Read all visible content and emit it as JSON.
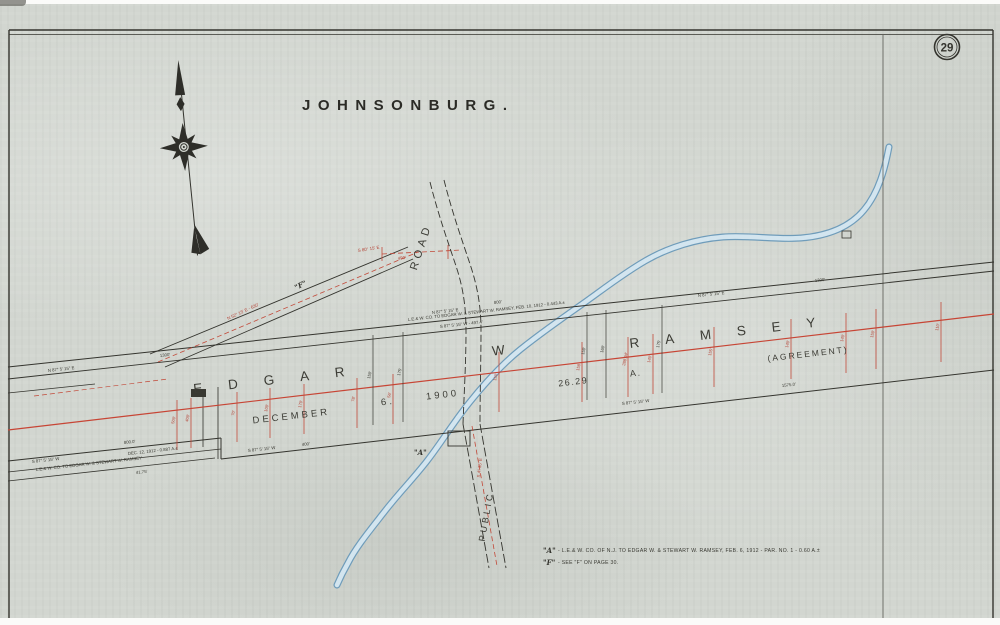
{
  "sheet": {
    "title": "JOHNSONBURG.",
    "number": "29"
  },
  "owner": {
    "first": "EDGAR",
    "middle": "W",
    "last": "RAMSEY"
  },
  "parcel": {
    "agreement": "(AGREEMENT)",
    "area_value": "26.29",
    "area_unit": "A.",
    "date_month": "DECEMBER",
    "date_day": "6.",
    "date_year": "1900"
  },
  "roads": {
    "road": "ROAD",
    "public": "PUBLIC",
    "public_bearing": "S 4° 35' E"
  },
  "spur": {
    "ref": "\"F\"",
    "bearing": "N 52° 15' E - 630'",
    "stub_bearing": "S 80° 15' E",
    "stub_length": "490'"
  },
  "boundaries": {
    "nw_bearing": "N 87° 5' 15\" E",
    "nw_length": "1300'",
    "band_length": "800'",
    "band_bearing_n": "N 87° 5' 15\" E",
    "band_deed": "L.E.& W. CO. TO EDGAR W. & STEWART W. RAMSEY, FEB. 10, 1912 - 0.443 A.±",
    "band_bearing_s": "S 87° 5' 15\" W - 497.4'",
    "ne_bearing": "N 87° 5' 15\" E",
    "ne_length": "1300'",
    "se_bearing": "S 87° 5' 15\" W",
    "se_length": "1575.0'",
    "s_mid_bearing": "S 87° 5' 15\" W",
    "s_mid_length": "400'",
    "sliver_length": "800.0'",
    "sliver_bearing": "S 87° 5' 15\" W",
    "sliver_deed_date": "DEC. 12, 1912 - 0.887 A.±",
    "sliver_deed": "L.E.& W. CO. TO EDGAR W. & STEWART W. RAMSEY",
    "sliver_dim": "41.75'",
    "crossing_ref": "\"A\""
  },
  "ticks": {
    "red": [
      "500'",
      "400'",
      "70'",
      "100'",
      "170'",
      "78'",
      "56'",
      "150'",
      "158'",
      "288.94'",
      "140'",
      "155'",
      "140'",
      "140'",
      "150'",
      "110'"
    ],
    "black": [
      "150'",
      "175'",
      "150'",
      "160'",
      "175'"
    ]
  },
  "notes": {
    "a_symbol": "\"A\"",
    "a_text": "- L.E.& W. CO. OF N.J. TO EDGAR W. & STEWART W. RAMSEY, FEB. 6, 1912 - PAR. NO. 1 - 0.60 A.±",
    "f_symbol": "\"F\"",
    "f_text": "- SEE \"F\" ON PAGE 30."
  },
  "colors": {
    "ink": "#34342e",
    "red": "#bf4a3c",
    "creek_edge": "#6f9cba",
    "creek_fill": "#d3e5ef",
    "paper": "#d2d6d0"
  }
}
